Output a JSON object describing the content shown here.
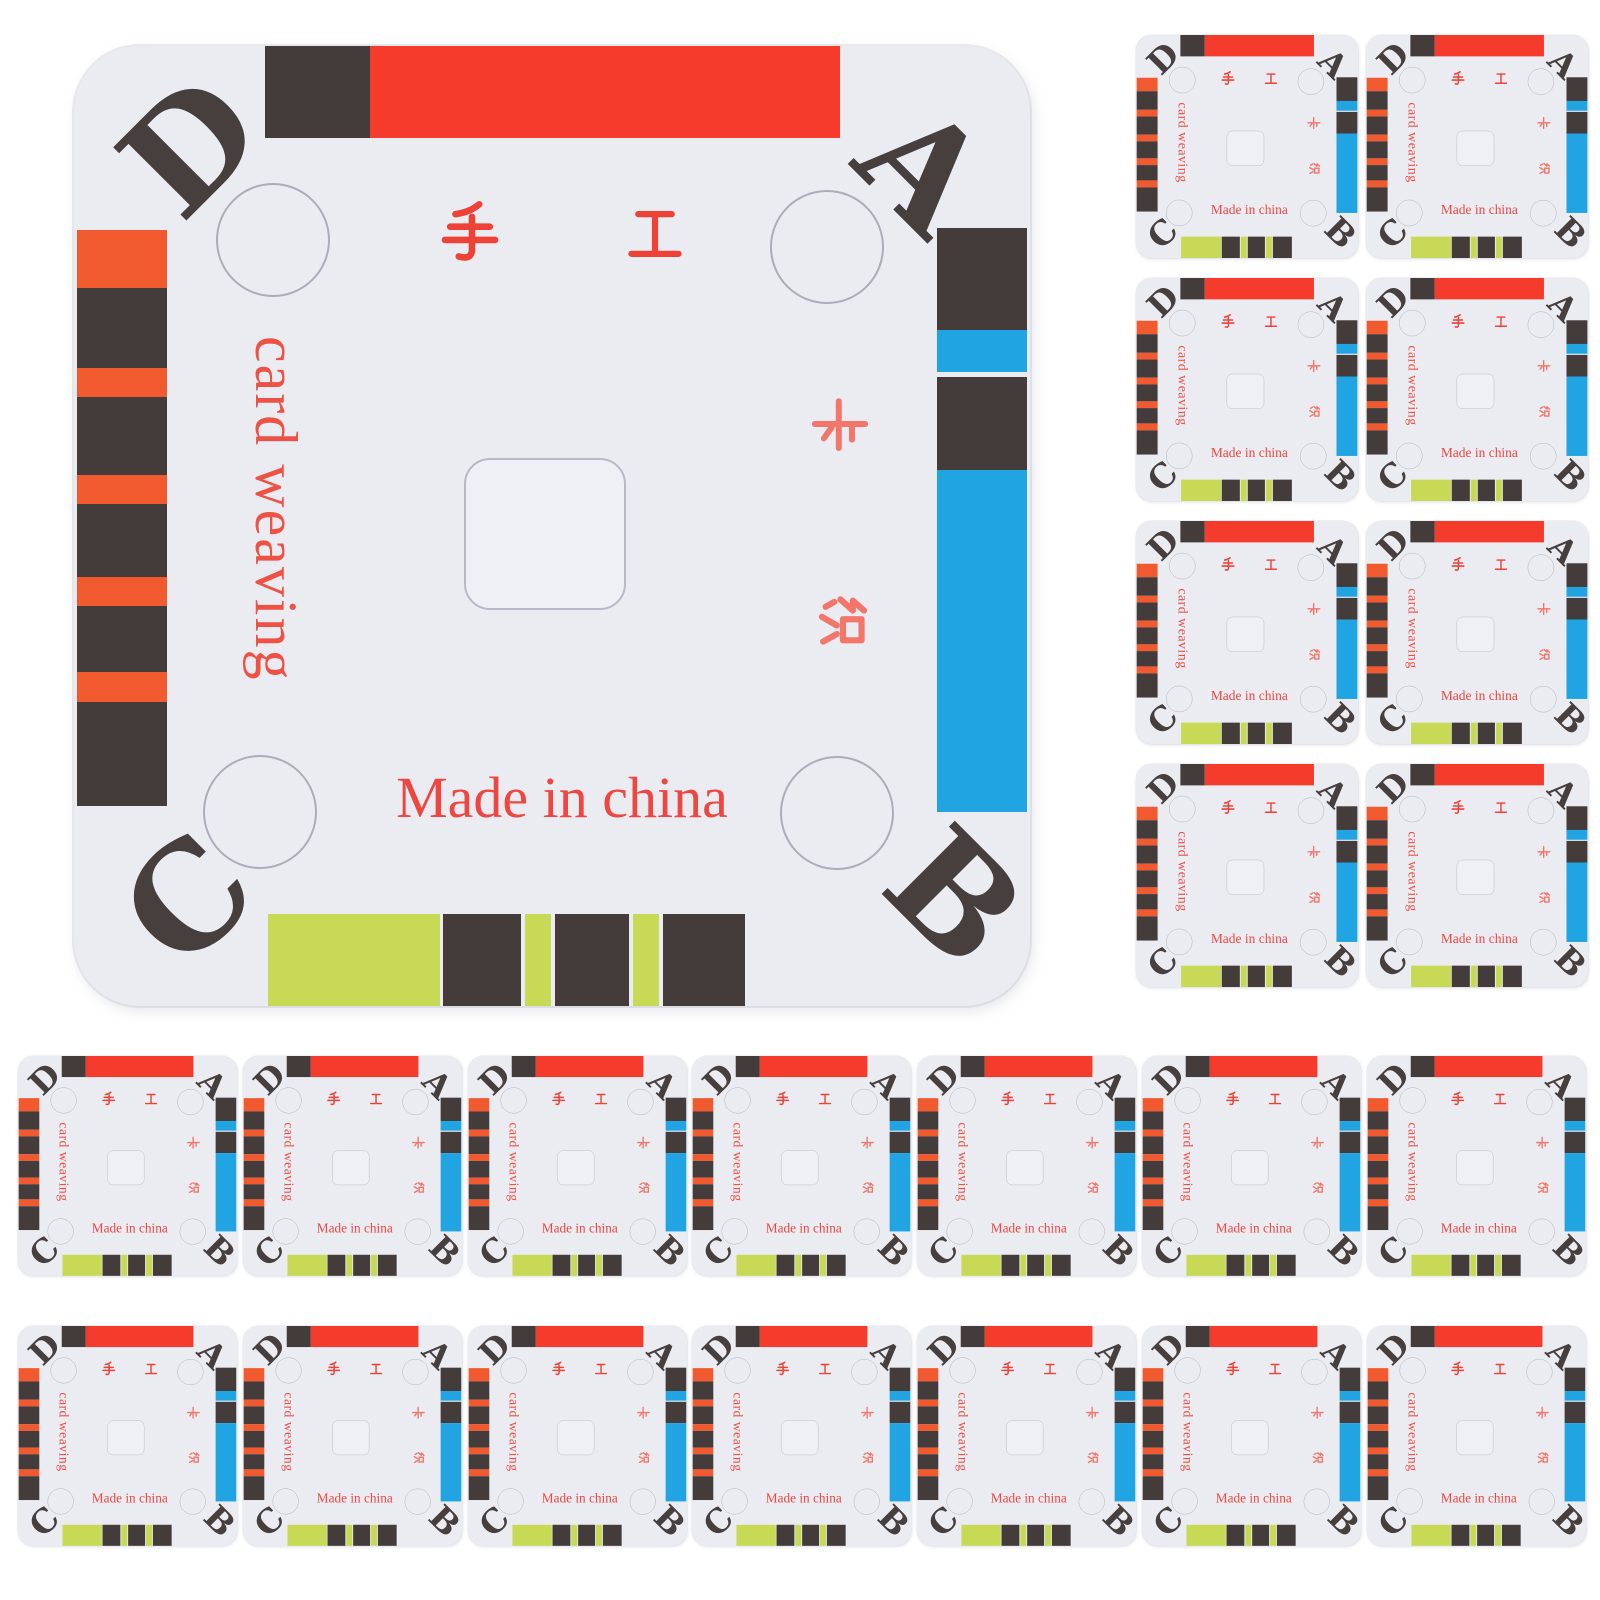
{
  "colors": {
    "background": "#ffffff",
    "card_bg": "#ebecf2",
    "red": "#f43b2c",
    "orange": "#f15a2e",
    "dark": "#443b3b",
    "blue": "#21a5e2",
    "green": "#c8da55",
    "corner_letter": "#473e3e",
    "hanzi_top": "#ee4236",
    "hanzi_side": "#f3766a",
    "latin_text": "#ee4741",
    "cut_line": "#a9aeb9"
  },
  "card": {
    "corners": {
      "top_left": "D",
      "top_right": "A",
      "bottom_left": "C",
      "bottom_right": "B"
    },
    "hanzi": {
      "shou": "手",
      "gong": "工",
      "ka": "卡",
      "zhi": "织"
    },
    "card_weaving": "card weaving",
    "made_in": "Made in china",
    "top_segments": [
      {
        "color": "dark",
        "w": 105
      },
      {
        "color": "red",
        "w": 470
      }
    ],
    "right_segments": [
      {
        "color": "dark",
        "h": 102
      },
      {
        "color": "blue",
        "h": 42
      },
      {
        "color": "dark",
        "h": 93,
        "gap": 5
      },
      {
        "color": "blue",
        "h": 342
      }
    ],
    "bottom_segments": [
      {
        "color": "green",
        "w": 172
      },
      {
        "color": "dark",
        "w": 78,
        "gap": 3
      },
      {
        "color": "green",
        "w": 26,
        "gap": 4
      },
      {
        "color": "dark",
        "w": 74,
        "gap": 4
      },
      {
        "color": "green",
        "w": 26,
        "gap": 4
      },
      {
        "color": "dark",
        "w": 82,
        "gap": 4
      }
    ],
    "left_stripes": [
      {
        "color": "orange",
        "h": 58
      },
      {
        "color": "dark",
        "h": 80
      },
      {
        "color": "orange",
        "h": 29
      },
      {
        "color": "dark",
        "h": 78
      },
      {
        "color": "orange",
        "h": 29
      },
      {
        "color": "dark",
        "h": 73
      },
      {
        "color": "orange",
        "h": 29
      },
      {
        "color": "dark",
        "h": 66
      },
      {
        "color": "orange",
        "h": 30
      },
      {
        "color": "dark",
        "h": 104
      }
    ]
  },
  "layout": {
    "card_base": {
      "w": 956,
      "h": 960
    },
    "instances": [
      {
        "x": 74,
        "y": 46,
        "s": 1
      },
      {
        "x": 1136,
        "y": 35,
        "s": 0.2323
      },
      {
        "x": 1366,
        "y": 35,
        "s": 0.2323
      },
      {
        "x": 1136,
        "y": 278,
        "s": 0.2323
      },
      {
        "x": 1366,
        "y": 278,
        "s": 0.2323
      },
      {
        "x": 1136,
        "y": 521,
        "s": 0.2323
      },
      {
        "x": 1366,
        "y": 521,
        "s": 0.2323
      },
      {
        "x": 1136,
        "y": 764,
        "s": 0.2323
      },
      {
        "x": 1366,
        "y": 764,
        "s": 0.2323
      },
      {
        "x": 18,
        "y": 1056,
        "s": 0.229
      },
      {
        "x": 243,
        "y": 1056,
        "s": 0.229
      },
      {
        "x": 468,
        "y": 1056,
        "s": 0.229
      },
      {
        "x": 692,
        "y": 1056,
        "s": 0.229
      },
      {
        "x": 917,
        "y": 1056,
        "s": 0.229
      },
      {
        "x": 1142,
        "y": 1056,
        "s": 0.229
      },
      {
        "x": 1367,
        "y": 1056,
        "s": 0.229
      },
      {
        "x": 18,
        "y": 1326,
        "s": 0.229
      },
      {
        "x": 243,
        "y": 1326,
        "s": 0.229
      },
      {
        "x": 468,
        "y": 1326,
        "s": 0.229
      },
      {
        "x": 692,
        "y": 1326,
        "s": 0.229
      },
      {
        "x": 917,
        "y": 1326,
        "s": 0.229
      },
      {
        "x": 1142,
        "y": 1326,
        "s": 0.229
      },
      {
        "x": 1367,
        "y": 1326,
        "s": 0.229
      }
    ]
  }
}
